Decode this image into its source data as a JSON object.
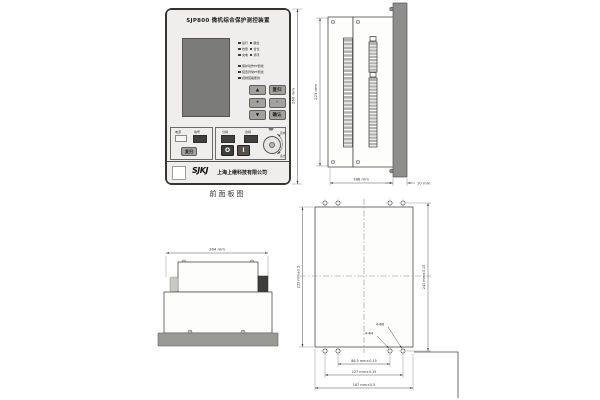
{
  "device": {
    "title": "SJP800 微机综合保护测控装置",
    "caption": "前面板图",
    "led_short": [
      "运行",
      "跳位",
      "告警",
      "合位",
      "充电",
      "通讯"
    ],
    "led_long": [
      "保护动作PT断线",
      "装置异常PT断线",
      "控制回路断线"
    ],
    "keys": [
      "▲",
      "复归",
      "+",
      "-",
      "▼",
      "确认"
    ],
    "aux_label_1": "电源",
    "aux_label_2": "信号",
    "aux_button": "复归",
    "op_label_1": "分闸",
    "op_label_2": "合闸",
    "btn_open": "O",
    "btn_close": "I",
    "switch_label_left": "就地",
    "switch_label_right": "远方",
    "logo": "SJKJ",
    "company": "上海上继科技有限公司"
  },
  "dims": {
    "front_height": "260 mm",
    "side_height": "223 mm",
    "side_depth": "188 mm",
    "panel_thickness": "10 mm",
    "top_width": "164 mm",
    "cutout_height": "225 mm±0.5",
    "cutout_outer_height": "240 mm±0.15",
    "hole_span_inner": "86.5 mm±0.15",
    "hole_span_outer": "127 mm±0.15",
    "cutout_width": "167 mm±0.5",
    "hole_note_1": "4-Φ6",
    "hole_note_2": "4-Φ4"
  },
  "colors": {
    "panel_face": "#efeeec",
    "lcd": "#7b7b79",
    "front_bar": "#8e8e8c",
    "line": "#4a4a4a"
  }
}
